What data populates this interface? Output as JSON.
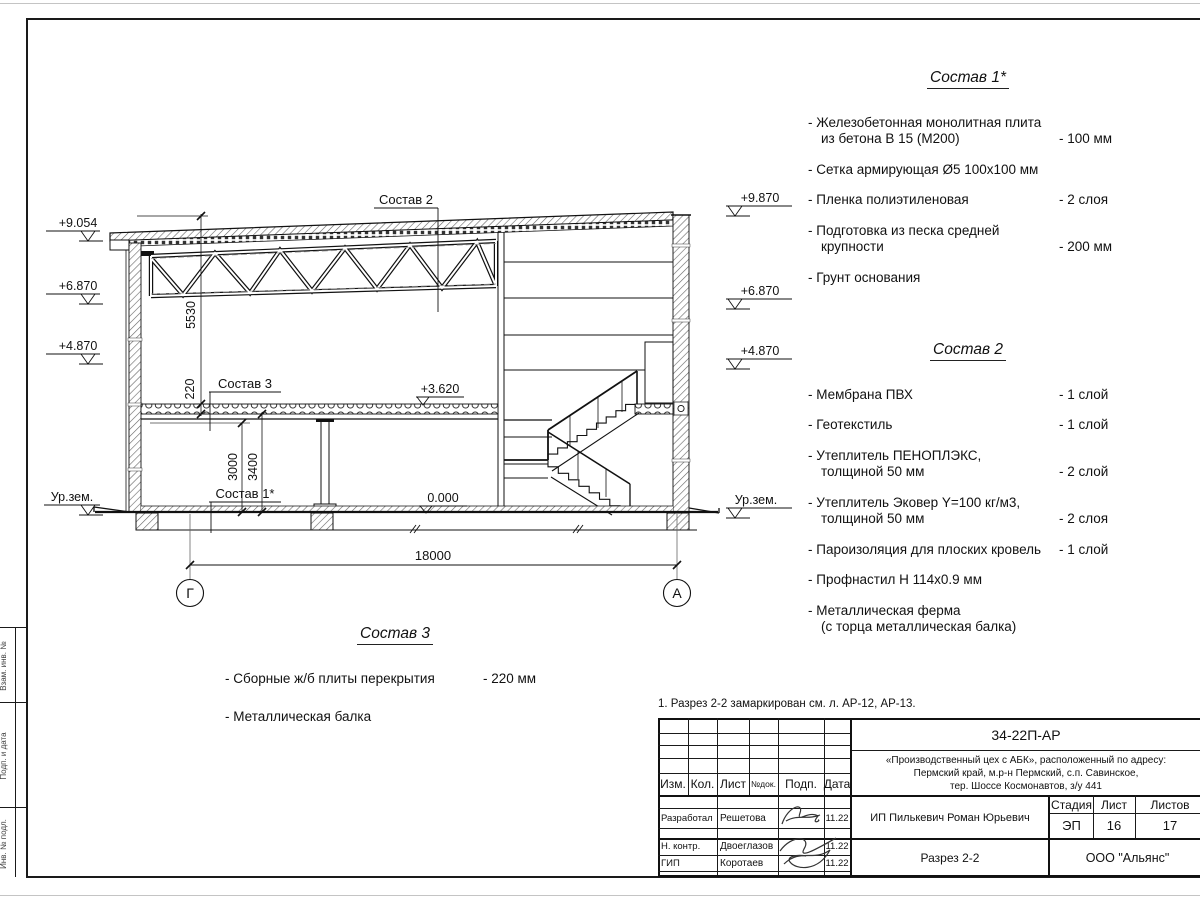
{
  "sheet": {
    "note": "1. Разрез 2-2 замаркирован см. л. АР-12, АР-13.",
    "side_tabs": [
      "Взам. инв. №",
      "Подп. и дата",
      "Инв. № подл."
    ]
  },
  "drawing": {
    "axes": {
      "left": "Г",
      "right": "А"
    },
    "dims": {
      "span": "18000",
      "hall_height": "5530",
      "slab": "220",
      "clear_height": "3000",
      "floor_height": "3400"
    },
    "levels": {
      "left": [
        "+9.054",
        "+6.870",
        "+4.870",
        "Ур.зем."
      ],
      "right": [
        "+9.870",
        "+6.870",
        "+4.870",
        "Ур.зем."
      ],
      "second_floor": "+3.620",
      "ground_floor": "0.000"
    },
    "callouts": {
      "roof": "Состав 2",
      "slab": "Состав 3",
      "floor": "Состав 1*"
    }
  },
  "lists": {
    "sostav1": {
      "title": "Состав 1*",
      "items": [
        {
          "name": "- Железобетонная  монолитная плита\nиз бетона В 15 (М200)",
          "value": "- 100 мм"
        },
        {
          "name": "- Сетка армирующая Ø5 100х100 мм",
          "value": ""
        },
        {
          "name": "- Пленка полиэтиленовая",
          "value": "-  2 слоя"
        },
        {
          "name": "- Подготовка из песка средней\nкрупности",
          "value": "- 200 мм"
        },
        {
          "name": "- Грунт основания",
          "value": ""
        }
      ]
    },
    "sostav2": {
      "title": "Состав 2",
      "items": [
        {
          "name": "- Мембрана ПВХ",
          "value": "- 1 слой"
        },
        {
          "name": "- Геотекстиль",
          "value": "- 1 слой"
        },
        {
          "name": "- Утеплитель ПЕНОПЛЭКС,\nтолщиной 50 мм",
          "value": "- 2 слой"
        },
        {
          "name": "- Утеплитель Эковер Y=100 кг/м3,\nтолщиной 50 мм",
          "value": "- 2 слоя"
        },
        {
          "name": "- Пароизоляция для плоских кровель",
          "value": "- 1 слой"
        },
        {
          "name": "- Профнастил Н 114х0.9 мм",
          "value": ""
        },
        {
          "name": "- Металлическая ферма\n(с торца металлическая балка)",
          "value": ""
        }
      ]
    },
    "sostav3": {
      "title": "Состав 3",
      "items": [
        {
          "name": "- Сборные ж/б  плиты перекрытия",
          "value": "- 220 мм"
        },
        {
          "name": "- Металлическая балка",
          "value": ""
        }
      ]
    }
  },
  "titleblock": {
    "doc_number": "34-22П-АР",
    "project_line1": "«Производственный цех с АБК», расположенный по адресу:",
    "project_line2": "Пермский край, м.р-н Пермский, с.п. Савинское,",
    "project_line3": "тер. Шоссе Космонавтов, з/у 441",
    "headers": {
      "izm": "Изм.",
      "kol": "Кол.",
      "list": "Лист",
      "ndok": "№док.",
      "podp": "Подп.",
      "data": "Дата"
    },
    "rows": [
      {
        "role": "Разработал",
        "name": "Решетова",
        "date": "11.22"
      },
      {
        "role": "Н. контр.",
        "name": "Двоеглазов",
        "date": "11.22"
      },
      {
        "role": "ГИП",
        "name": "Коротаев",
        "date": "11.22"
      }
    ],
    "client": "ИП Пилькевич Роман Юрьевич",
    "stage_label": "Стадия",
    "sheet_label": "Лист",
    "sheets_label": "Листов",
    "stage": "ЭП",
    "sheet": "16",
    "sheets": "17",
    "section_title": "Разрез 2-2",
    "company": "ООО \"Альянс\""
  }
}
